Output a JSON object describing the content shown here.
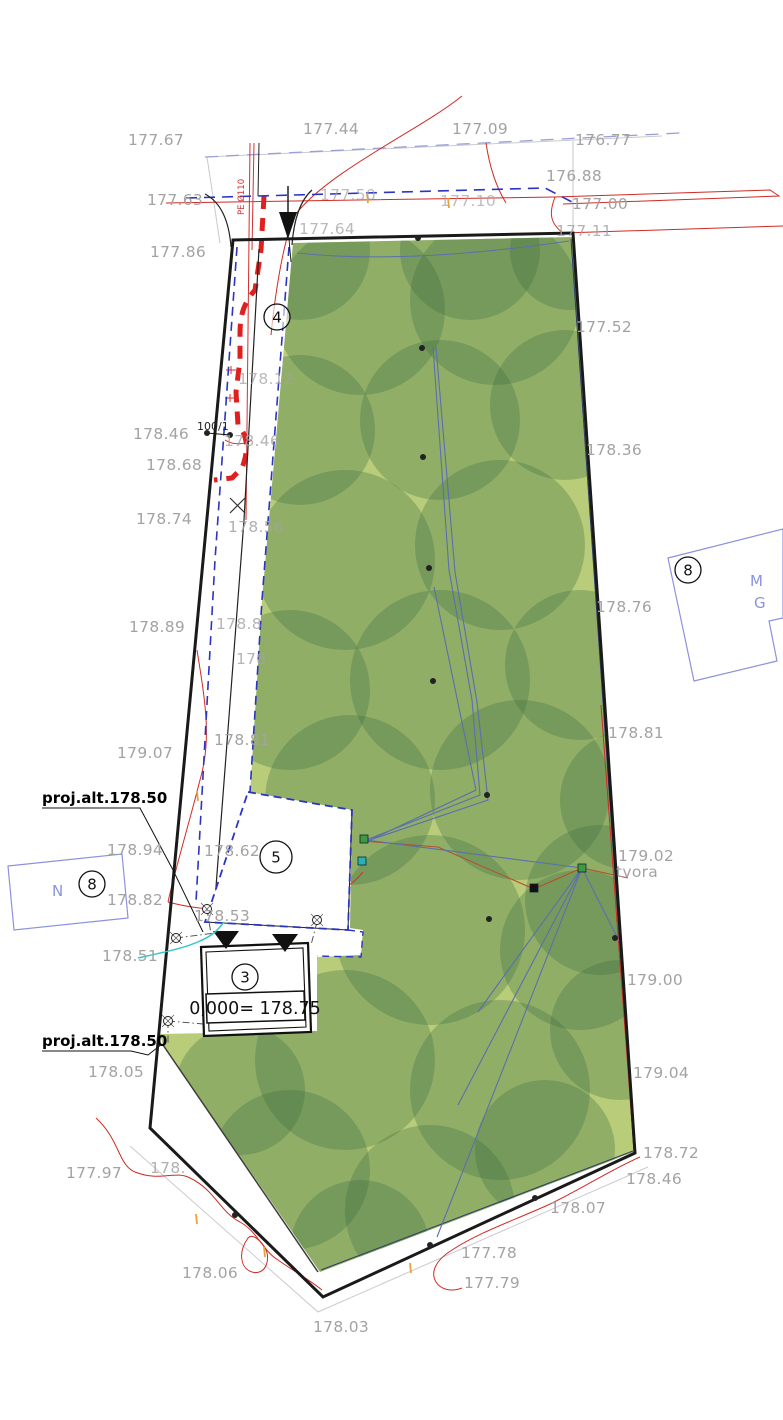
{
  "colors": {
    "boundary": "#1a1a1a",
    "green_base": "#b8cc79",
    "canopy": "#3f7040",
    "blue_dash": "#2b35c0",
    "light_dash": "#9aa0d8",
    "utility_blue": "#5b6fae",
    "red": "#cf2b24",
    "pipe_red": "#e01f1f",
    "cyan": "#35c8c8",
    "label_gray": "#a3a3a3",
    "neighbor_blue": "#8a93dd",
    "orange": "#e8a33d"
  },
  "annotations": {
    "upper": "proj.alt.178.50",
    "lower": "proj.alt.178.50"
  },
  "texts": {
    "level_value": "0,000= 178.75",
    "parcel_number": "100/1",
    "fence_label": "tvora",
    "pipe_label": "PE Ø110",
    "neighbor_left_letter": "N",
    "neighbor_right_letter_1": "M",
    "neighbor_right_letter_2": "G"
  },
  "circled_numbers": [
    {
      "n": "4",
      "x": 277,
      "y": 317,
      "r": 13
    },
    {
      "n": "5",
      "x": 276,
      "y": 857,
      "r": 16
    },
    {
      "n": "3",
      "x": 245,
      "y": 977,
      "r": 13
    },
    {
      "n": "8",
      "x": 92,
      "y": 884,
      "r": 13
    },
    {
      "n": "8",
      "x": 688,
      "y": 570,
      "r": 13
    }
  ],
  "elevation_labels": [
    {
      "t": "177.67",
      "x": 128,
      "y": 145
    },
    {
      "t": "177.44",
      "x": 303,
      "y": 134
    },
    {
      "t": "177.09",
      "x": 452,
      "y": 134
    },
    {
      "t": "176.77",
      "x": 575,
      "y": 145
    },
    {
      "t": "176.88",
      "x": 546,
      "y": 181
    },
    {
      "t": "177.63",
      "x": 147,
      "y": 205
    },
    {
      "t": "177.50",
      "x": 320,
      "y": 200,
      "o": 0.7
    },
    {
      "t": "177.10",
      "x": 440,
      "y": 206,
      "o": 0.7
    },
    {
      "t": "177.00",
      "x": 572,
      "y": 209
    },
    {
      "t": "177.64",
      "x": 299,
      "y": 234,
      "o": 0.75
    },
    {
      "t": "177.11",
      "x": 556,
      "y": 236,
      "o": 0.8
    },
    {
      "t": "177.86",
      "x": 150,
      "y": 257
    },
    {
      "t": "177.52",
      "x": 576,
      "y": 332
    },
    {
      "t": "178.12",
      "x": 238,
      "y": 384,
      "o": 0.75
    },
    {
      "t": "178.46",
      "x": 133,
      "y": 439
    },
    {
      "t": "178.46",
      "x": 224,
      "y": 446,
      "o": 0.8
    },
    {
      "t": "178.68",
      "x": 146,
      "y": 470
    },
    {
      "t": "178.36",
      "x": 586,
      "y": 455
    },
    {
      "t": "178.74",
      "x": 136,
      "y": 524
    },
    {
      "t": "178.56",
      "x": 228,
      "y": 532,
      "o": 0.85
    },
    {
      "t": "178.89",
      "x": 129,
      "y": 632
    },
    {
      "t": "178.8",
      "x": 216,
      "y": 629,
      "o": 0.8
    },
    {
      "t": "178",
      "x": 236,
      "y": 664,
      "o": 0.8
    },
    {
      "t": "178.76",
      "x": 596,
      "y": 612
    },
    {
      "t": "178.81",
      "x": 214,
      "y": 745
    },
    {
      "t": "179.07",
      "x": 117,
      "y": 758
    },
    {
      "t": "178.81",
      "x": 608,
      "y": 738
    },
    {
      "t": "178.94",
      "x": 107,
      "y": 855
    },
    {
      "t": "178.62",
      "x": 204,
      "y": 856
    },
    {
      "t": "178.82",
      "x": 107,
      "y": 905
    },
    {
      "t": "178.53",
      "x": 194,
      "y": 921
    },
    {
      "t": "178.51",
      "x": 102,
      "y": 961
    },
    {
      "t": "179.02",
      "x": 618,
      "y": 861
    },
    {
      "t": "179.00",
      "x": 627,
      "y": 985
    },
    {
      "t": "179.04",
      "x": 633,
      "y": 1078
    },
    {
      "t": "178.72",
      "x": 643,
      "y": 1158
    },
    {
      "t": "178.46",
      "x": 626,
      "y": 1184
    },
    {
      "t": "178.05",
      "x": 88,
      "y": 1077
    },
    {
      "t": "177.97",
      "x": 66,
      "y": 1178
    },
    {
      "t": "178.",
      "x": 150,
      "y": 1173,
      "o": 0.85
    },
    {
      "t": "178.07",
      "x": 550,
      "y": 1213
    },
    {
      "t": "177.78",
      "x": 461,
      "y": 1258
    },
    {
      "t": "177.79",
      "x": 464,
      "y": 1288
    },
    {
      "t": "178.06",
      "x": 182,
      "y": 1278
    },
    {
      "t": "178.03",
      "x": 313,
      "y": 1332
    }
  ],
  "symbols": {
    "tree_points": [
      [
        422,
        348
      ],
      [
        423,
        457
      ],
      [
        429,
        568
      ],
      [
        433,
        681
      ],
      [
        487,
        795
      ],
      [
        489,
        919
      ],
      [
        615,
        938
      ],
      [
        235,
        1215
      ],
      [
        430,
        1245
      ],
      [
        535,
        1198
      ],
      [
        418,
        238
      ],
      [
        207,
        433
      ],
      [
        230,
        435
      ]
    ],
    "poles": [
      [
        364,
        839,
        "#3f9a3f"
      ],
      [
        582,
        868,
        "#3f9a3f"
      ],
      [
        362,
        861,
        "#2ab2b2"
      ],
      [
        534,
        888,
        "#111111"
      ]
    ],
    "monuments": [
      [
        176,
        938
      ],
      [
        207,
        909
      ],
      [
        317,
        920
      ],
      [
        168,
        1021
      ]
    ],
    "orange_ticks": [
      [
        367,
        193
      ],
      [
        448,
        198
      ],
      [
        197,
        791
      ],
      [
        196,
        1214
      ],
      [
        264,
        1247
      ],
      [
        410,
        1263
      ]
    ]
  },
  "canopy_circles": [
    [
      360,
      310,
      85
    ],
    [
      495,
      300,
      85
    ],
    [
      300,
      430,
      75
    ],
    [
      440,
      420,
      80
    ],
    [
      565,
      405,
      75
    ],
    [
      345,
      560,
      90
    ],
    [
      500,
      545,
      85
    ],
    [
      290,
      690,
      80
    ],
    [
      440,
      680,
      90
    ],
    [
      580,
      665,
      75
    ],
    [
      350,
      800,
      85
    ],
    [
      520,
      790,
      90
    ],
    [
      630,
      800,
      70
    ],
    [
      430,
      930,
      95
    ],
    [
      580,
      950,
      80
    ],
    [
      345,
      1060,
      90
    ],
    [
      500,
      1090,
      90
    ],
    [
      620,
      1030,
      70
    ],
    [
      290,
      1170,
      80
    ],
    [
      430,
      1210,
      85
    ],
    [
      545,
      1150,
      70
    ],
    [
      240,
      1090,
      65
    ],
    [
      360,
      1250,
      70
    ],
    [
      600,
      900,
      75
    ],
    [
      300,
      250,
      70
    ],
    [
      470,
      250,
      70
    ],
    [
      570,
      250,
      60
    ]
  ]
}
